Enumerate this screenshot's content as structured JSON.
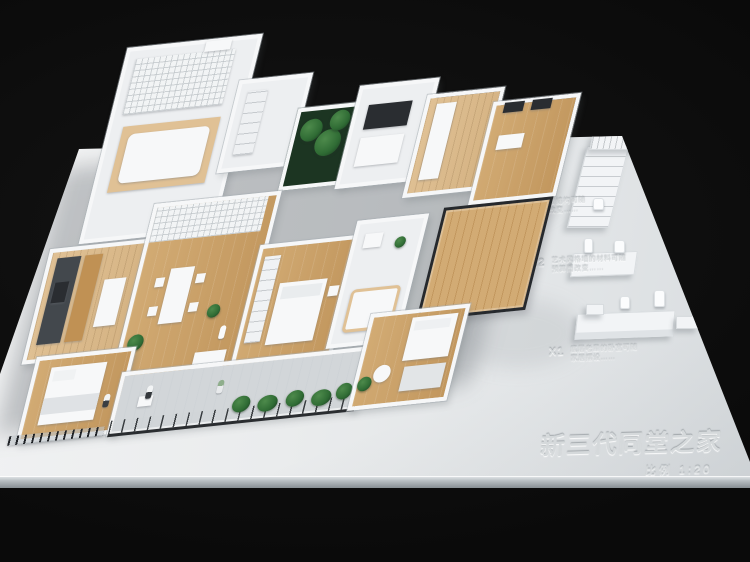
{
  "photo": {
    "description": "studio photograph of a white architectural scale model of an apartment on a white display base, black background",
    "colors": {
      "bg": "#0a0a0a",
      "base": "#eaeced",
      "wall": "#f6f7f8",
      "wood": "#d2ab74",
      "wood2": "#c2975e",
      "woodlight": "#e0c195",
      "plant": "#2f6b34",
      "frame": "#26292d",
      "deck": "#ced3d6",
      "counter": "#43484d",
      "engrave": "#d5d9db"
    }
  },
  "nameplate": {
    "title": "新三代同堂之家",
    "scale": "比例 1:20"
  },
  "callouts": [
    {
      "label": "X3",
      "caption1": "小阁楼结构可随",
      "caption2": "需求改变……"
    },
    {
      "label": "X2",
      "caption1": "艺术风格墙的材料可随",
      "caption2": "预算而改变……"
    },
    {
      "label": "X1",
      "caption1": "底层老辈的卧室可随",
      "caption2": "家居摆设……"
    }
  ]
}
